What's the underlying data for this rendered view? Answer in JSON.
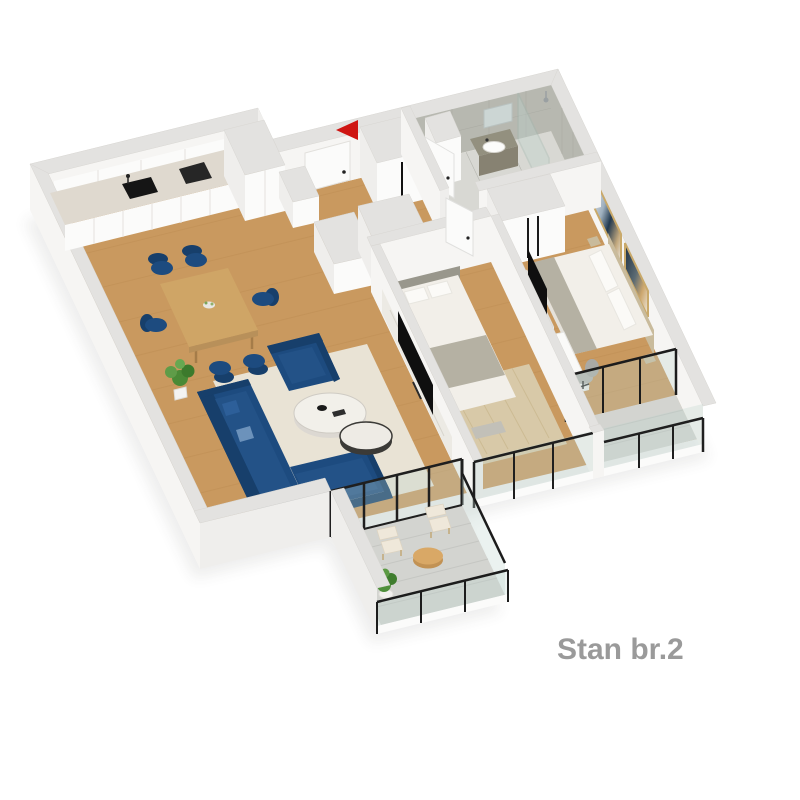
{
  "label": {
    "text": "Stan br.2"
  },
  "entrance_marker": {
    "icon": "red-arrow-left",
    "color": "#cf1512"
  },
  "palette": {
    "bg": "#ffffff",
    "wall": "#f6f5f3",
    "wall_side": "#efeeec",
    "wall_top": "#e3e2e0",
    "wood": "#c9995f",
    "plank": "#b9884f",
    "tile": "#b7b8b0",
    "bath_floor": "#d8d8d3",
    "balcony": "#d3d4d0",
    "balcony_line": "#c5c6c2",
    "navy": "#1d4b7f",
    "navy_dark": "#173f6b",
    "navy_light": "#235287",
    "cream": "#efe8da",
    "rug": "#e9e3d5",
    "jute": "#d8c9a8",
    "marble": "#eceae4",
    "counter": "#dfd9cf",
    "table_wood": "#cfa566",
    "black": "#151515",
    "glass": "#bcd3cd",
    "linen": "#f2efe9",
    "gray_textile": "#b5b1a3",
    "tan": "#c9bb9c",
    "text": "#9a9a9a",
    "red": "#cf1512"
  }
}
